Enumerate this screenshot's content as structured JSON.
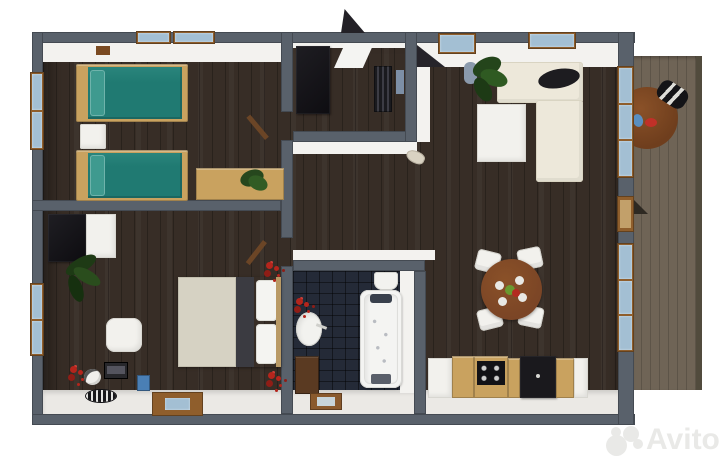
{
  "watermark": {
    "brand": "Avito",
    "logo": "four-circles-logo",
    "color": "#e9e9e7"
  },
  "colors": {
    "background": "#ffffff",
    "wall": "#59616b",
    "floor": "#372d26",
    "white_face": "#f3f2ef",
    "south_strip": "#ebe9e5",
    "tile": "#242a37",
    "deck": "#6f6456",
    "teal": "#207a72",
    "bed_frame": "#c9a25f",
    "cream": "#ede8da",
    "glass": "#a3bfd3",
    "frame_brown": "#8f5e2c",
    "table_brown": "#7b4526",
    "white_furn": "#f2f1ed",
    "dark_furn": "#1a191d",
    "beige": "#d6d2c3",
    "red": "#b5251c",
    "green": "#2c5523",
    "blue_item": "#4a7fb5",
    "watermark": "#e9e9e7"
  },
  "scene": {
    "type": "3d-floorplan-render",
    "rooms": [
      {
        "name": "twin-bedroom",
        "furniture": [
          "twin-bed-teal",
          "twin-bed-teal",
          "white-nightstand",
          "wood-desk",
          "desk-plant",
          "left-window",
          "top-window",
          "top-window"
        ]
      },
      {
        "name": "entry-hall",
        "furniture": [
          "dark-wardrobe",
          "open-front-door",
          "radiator",
          "wall-mirror"
        ]
      },
      {
        "name": "living-room",
        "furniture": [
          "cream-corner-sofa",
          "dark-cushion",
          "white-coffee-table",
          "potted-plant",
          "top-window",
          "top-window",
          "tall-window"
        ]
      },
      {
        "name": "dining-kitchen",
        "furniture": [
          "round-dining-table",
          "plates",
          "white-chair",
          "white-chair",
          "white-chair",
          "white-chair",
          "kitchen-counter",
          "cooktop",
          "oven-cabinet",
          "tall-window",
          "deck-door"
        ]
      },
      {
        "name": "double-bedroom",
        "furniture": [
          "double-bed",
          "dark-wardrobe",
          "white-cabinet",
          "potted-plant",
          "white-armchair",
          "tv-box",
          "blue-box",
          "round-rug",
          "red-flowers",
          "left-window",
          "bottom-window"
        ]
      },
      {
        "name": "bathroom",
        "furniture": [
          "bathtub",
          "toilet",
          "pedestal-sink",
          "red-flowers",
          "wood-vanity",
          "bath-mat"
        ]
      },
      {
        "name": "deck",
        "furniture": [
          "round-wood-table",
          "striped-lounge-chair",
          "tableware"
        ]
      }
    ]
  }
}
